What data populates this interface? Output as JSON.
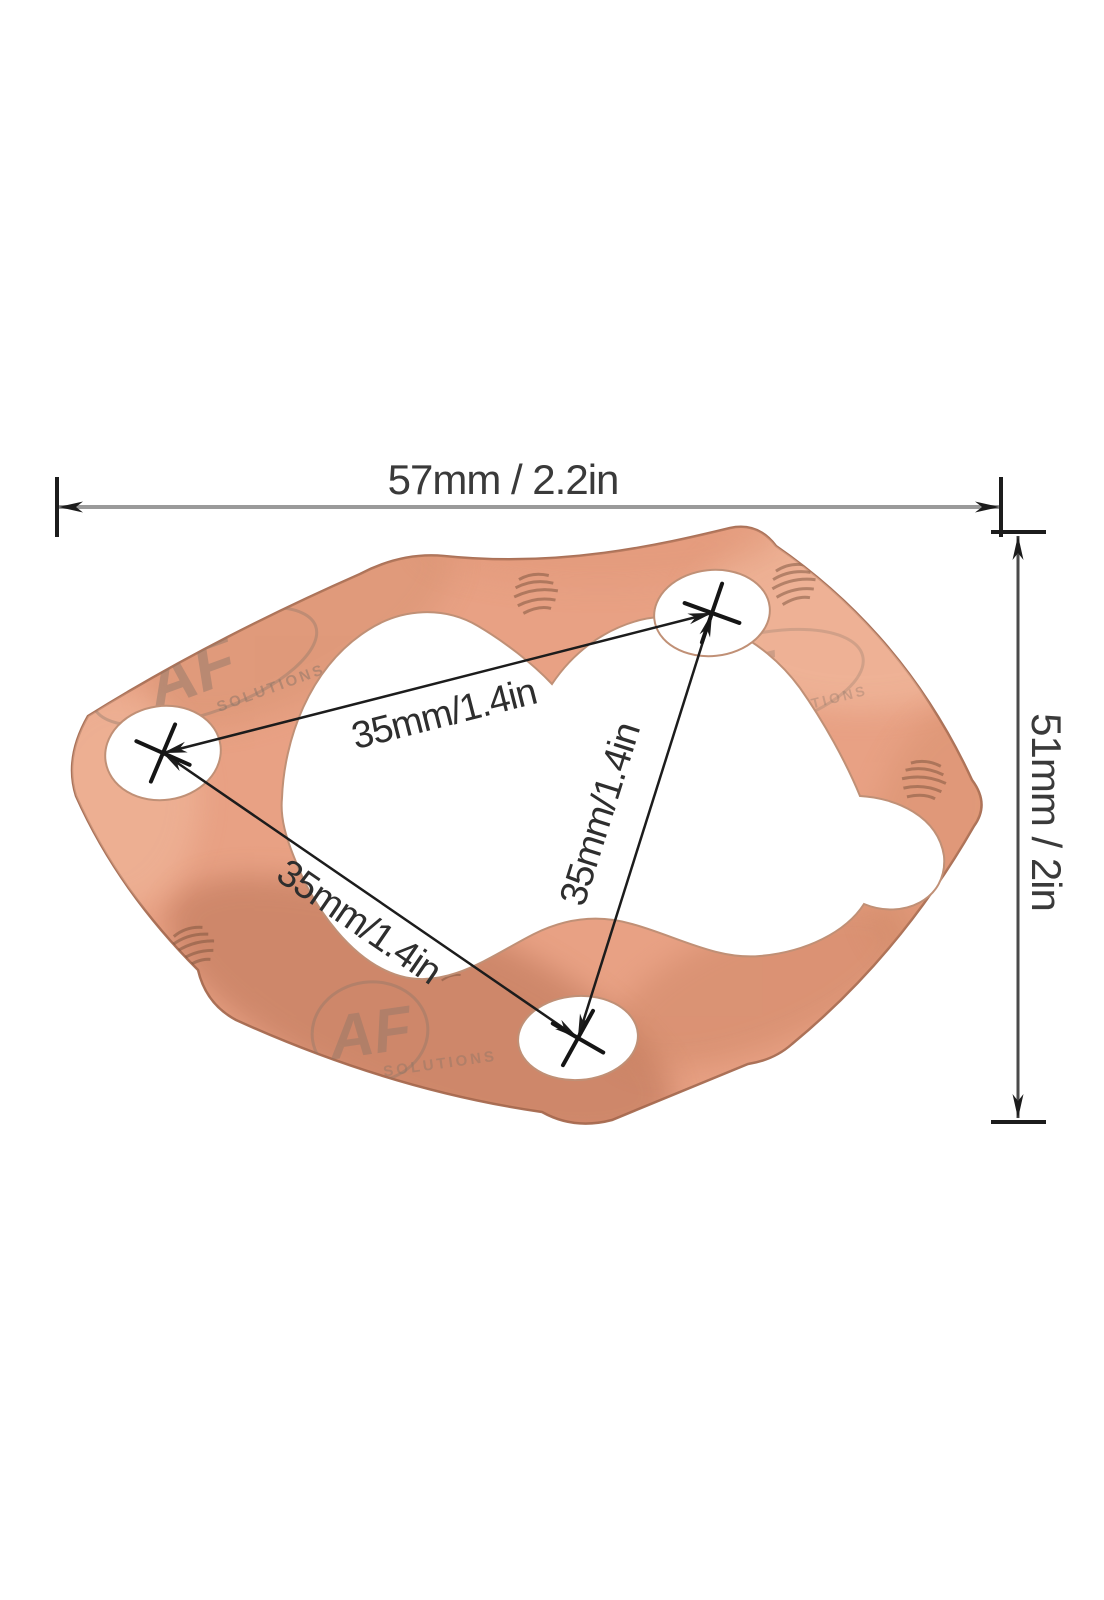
{
  "figure": {
    "object": "copper-gasket",
    "bolt_holes": 3
  },
  "diagram": {
    "dimensions": {
      "overall_width": {
        "label": "57mm / 2.2in",
        "mm": 57,
        "in": 2.2
      },
      "overall_height": {
        "label": "51mm / 2in",
        "mm": 51,
        "in": 2
      },
      "hole_spacing_top": {
        "label": "35mm/1.4in",
        "mm": 35,
        "in": 1.4
      },
      "hole_spacing_left": {
        "label": "35mm/1.4in",
        "mm": 35,
        "in": 1.4
      },
      "hole_spacing_right": {
        "label": "35mm/1.4in",
        "mm": 35,
        "in": 1.4
      }
    },
    "watermark": {
      "brand": "AF",
      "subtext": "SOLUTIONS"
    },
    "colors": {
      "background": "#ffffff",
      "copper": "#e8a184",
      "copper_light": "#f3c0a4",
      "copper_dark": "#c57d5c",
      "copper_shadow": "#a86245",
      "gasket_edge": "#aa7158",
      "hole_fill": "#ffffff",
      "dim_line_gray": "#9a9a9a",
      "dim_line_dark": "#4a4a4a",
      "arrow_black": "#1c1c1c",
      "dim_text": "#3a3a3a",
      "watermark_gray": "#8a7568"
    }
  }
}
